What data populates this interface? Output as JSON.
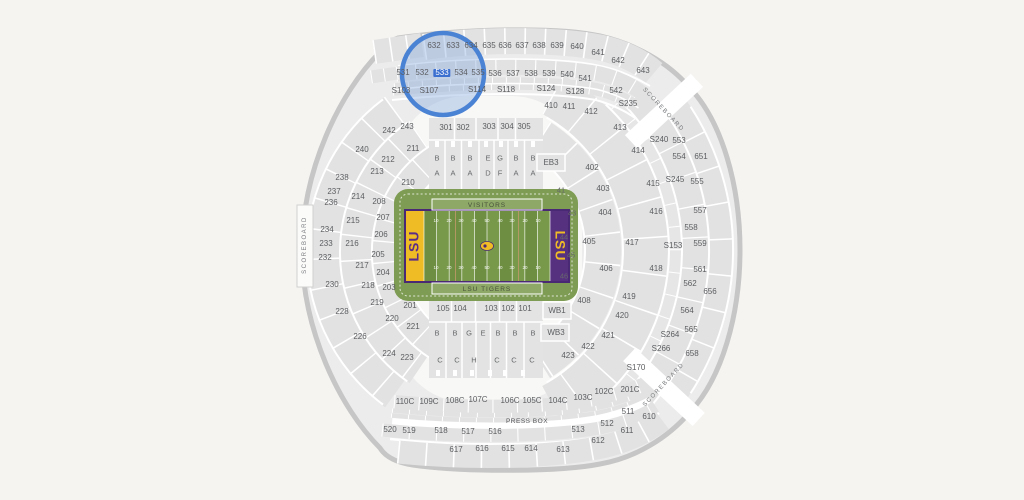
{
  "map": {
    "title": "stadium-seating-map",
    "background": "#f5f4f1",
    "highlight": {
      "section": "533",
      "circle_color": "#4a82d4",
      "circle_fill": "rgba(128,166,224,0.38)",
      "x": 443,
      "y": 74,
      "r": 41
    },
    "field": {
      "home_label": "LSU",
      "visitors_label": "VISITORS",
      "home_team_label": "LSU TIGERS",
      "colors": {
        "turf": "#6e8f41",
        "turf_stripe": "#78984a",
        "surround": "#7e9c53",
        "end_zone_left": "#efbc25",
        "end_zone_right": "#563180",
        "border": "#4a2974",
        "lsu_gold": "#f0bc26",
        "lsu_purple": "#5b2d87"
      }
    },
    "labels": [
      {
        "t": "632",
        "x": 434,
        "y": 46
      },
      {
        "t": "633",
        "x": 453,
        "y": 46
      },
      {
        "t": "634",
        "x": 471,
        "y": 46
      },
      {
        "t": "635",
        "x": 489,
        "y": 46
      },
      {
        "t": "636",
        "x": 505,
        "y": 46
      },
      {
        "t": "637",
        "x": 522,
        "y": 46
      },
      {
        "t": "638",
        "x": 539,
        "y": 46
      },
      {
        "t": "639",
        "x": 557,
        "y": 46
      },
      {
        "t": "640",
        "x": 577,
        "y": 47
      },
      {
        "t": "641",
        "x": 598,
        "y": 53
      },
      {
        "t": "642",
        "x": 618,
        "y": 61
      },
      {
        "t": "643",
        "x": 643,
        "y": 71
      },
      {
        "t": "531",
        "x": 403,
        "y": 73
      },
      {
        "t": "532",
        "x": 422,
        "y": 73
      },
      {
        "t": "533",
        "x": 442,
        "y": 73
      },
      {
        "t": "534",
        "x": 461,
        "y": 73
      },
      {
        "t": "535",
        "x": 478,
        "y": 73
      },
      {
        "t": "536",
        "x": 495,
        "y": 74
      },
      {
        "t": "537",
        "x": 513,
        "y": 74
      },
      {
        "t": "538",
        "x": 531,
        "y": 74
      },
      {
        "t": "539",
        "x": 549,
        "y": 74
      },
      {
        "t": "540",
        "x": 567,
        "y": 75
      },
      {
        "t": "541",
        "x": 585,
        "y": 79
      },
      {
        "t": "542",
        "x": 616,
        "y": 91
      },
      {
        "t": "S103",
        "x": 401,
        "y": 91
      },
      {
        "t": "S107",
        "x": 429,
        "y": 91
      },
      {
        "t": "S114",
        "x": 477,
        "y": 90
      },
      {
        "t": "S118",
        "x": 506,
        "y": 90
      },
      {
        "t": "S124",
        "x": 546,
        "y": 89
      },
      {
        "t": "S128",
        "x": 575,
        "y": 92
      },
      {
        "t": "S235",
        "x": 628,
        "y": 104
      },
      {
        "t": "410",
        "x": 551,
        "y": 106
      },
      {
        "t": "411",
        "x": 569,
        "y": 107
      },
      {
        "t": "412",
        "x": 591,
        "y": 112
      },
      {
        "t": "413",
        "x": 620,
        "y": 128
      },
      {
        "t": "414",
        "x": 638,
        "y": 151
      },
      {
        "t": "415",
        "x": 653,
        "y": 184
      },
      {
        "t": "416",
        "x": 656,
        "y": 212
      },
      {
        "t": "417",
        "x": 632,
        "y": 243
      },
      {
        "t": "418",
        "x": 656,
        "y": 269
      },
      {
        "t": "419",
        "x": 629,
        "y": 297
      },
      {
        "t": "420",
        "x": 622,
        "y": 316
      },
      {
        "t": "421",
        "x": 608,
        "y": 336
      },
      {
        "t": "422",
        "x": 588,
        "y": 347
      },
      {
        "t": "423",
        "x": 568,
        "y": 356
      },
      {
        "t": "402",
        "x": 592,
        "y": 168
      },
      {
        "t": "403",
        "x": 603,
        "y": 189
      },
      {
        "t": "404",
        "x": 605,
        "y": 213
      },
      {
        "t": "405",
        "x": 589,
        "y": 242
      },
      {
        "t": "406",
        "x": 606,
        "y": 269
      },
      {
        "t": "408",
        "x": 584,
        "y": 301
      },
      {
        "t": "S240",
        "x": 659,
        "y": 140
      },
      {
        "t": "553",
        "x": 679,
        "y": 141
      },
      {
        "t": "554",
        "x": 679,
        "y": 157
      },
      {
        "t": "651",
        "x": 701,
        "y": 157
      },
      {
        "t": "S245",
        "x": 675,
        "y": 180
      },
      {
        "t": "555",
        "x": 697,
        "y": 182
      },
      {
        "t": "557",
        "x": 700,
        "y": 211
      },
      {
        "t": "558",
        "x": 691,
        "y": 228
      },
      {
        "t": "559",
        "x": 700,
        "y": 244
      },
      {
        "t": "S153",
        "x": 673,
        "y": 246
      },
      {
        "t": "561",
        "x": 700,
        "y": 270
      },
      {
        "t": "562",
        "x": 690,
        "y": 284
      },
      {
        "t": "656",
        "x": 710,
        "y": 292
      },
      {
        "t": "564",
        "x": 687,
        "y": 311
      },
      {
        "t": "565",
        "x": 691,
        "y": 330
      },
      {
        "t": "S264",
        "x": 670,
        "y": 335
      },
      {
        "t": "S266",
        "x": 661,
        "y": 349
      },
      {
        "t": "658",
        "x": 692,
        "y": 354
      },
      {
        "t": "S170",
        "x": 636,
        "y": 368
      },
      {
        "t": "240",
        "x": 362,
        "y": 150
      },
      {
        "t": "238",
        "x": 342,
        "y": 178
      },
      {
        "t": "237",
        "x": 334,
        "y": 192
      },
      {
        "t": "236",
        "x": 331,
        "y": 203
      },
      {
        "t": "234",
        "x": 327,
        "y": 230
      },
      {
        "t": "233",
        "x": 326,
        "y": 244
      },
      {
        "t": "232",
        "x": 325,
        "y": 258
      },
      {
        "t": "230",
        "x": 332,
        "y": 285
      },
      {
        "t": "228",
        "x": 342,
        "y": 312
      },
      {
        "t": "226",
        "x": 360,
        "y": 337
      },
      {
        "t": "224",
        "x": 389,
        "y": 354
      },
      {
        "t": "242",
        "x": 389,
        "y": 131
      },
      {
        "t": "243",
        "x": 407,
        "y": 127
      },
      {
        "t": "211",
        "x": 413,
        "y": 149
      },
      {
        "t": "212",
        "x": 388,
        "y": 160
      },
      {
        "t": "213",
        "x": 377,
        "y": 172
      },
      {
        "t": "214",
        "x": 358,
        "y": 197
      },
      {
        "t": "215",
        "x": 353,
        "y": 221
      },
      {
        "t": "216",
        "x": 352,
        "y": 244
      },
      {
        "t": "217",
        "x": 362,
        "y": 266
      },
      {
        "t": "218",
        "x": 368,
        "y": 286
      },
      {
        "t": "219",
        "x": 377,
        "y": 303
      },
      {
        "t": "220",
        "x": 392,
        "y": 319
      },
      {
        "t": "221",
        "x": 413,
        "y": 327
      },
      {
        "t": "223",
        "x": 407,
        "y": 358
      },
      {
        "t": "210",
        "x": 408,
        "y": 183
      },
      {
        "t": "208",
        "x": 379,
        "y": 202
      },
      {
        "t": "207",
        "x": 383,
        "y": 218
      },
      {
        "t": "206",
        "x": 381,
        "y": 235
      },
      {
        "t": "205",
        "x": 378,
        "y": 255
      },
      {
        "t": "204",
        "x": 383,
        "y": 273
      },
      {
        "t": "203",
        "x": 389,
        "y": 288
      },
      {
        "t": "201",
        "x": 410,
        "y": 306
      },
      {
        "t": "301",
        "x": 446,
        "y": 128
      },
      {
        "t": "302",
        "x": 463,
        "y": 128
      },
      {
        "t": "303",
        "x": 489,
        "y": 127
      },
      {
        "t": "304",
        "x": 507,
        "y": 127
      },
      {
        "t": "305",
        "x": 524,
        "y": 127
      },
      {
        "t": "EB3",
        "x": 551,
        "y": 163
      },
      {
        "t": "WB1",
        "x": 557,
        "y": 311
      },
      {
        "t": "WB3",
        "x": 556,
        "y": 333
      },
      {
        "t": "105",
        "x": 443,
        "y": 309
      },
      {
        "t": "104",
        "x": 460,
        "y": 309
      },
      {
        "t": "103",
        "x": 491,
        "y": 309
      },
      {
        "t": "102",
        "x": 508,
        "y": 309
      },
      {
        "t": "101",
        "x": 525,
        "y": 309
      },
      {
        "t": "B",
        "x": 437,
        "y": 158,
        "c": "lt",
        "st": 1
      },
      {
        "t": "B",
        "x": 453,
        "y": 158,
        "c": "lt",
        "st": 1
      },
      {
        "t": "B",
        "x": 470,
        "y": 158,
        "c": "lt",
        "st": 1
      },
      {
        "t": "E",
        "x": 488,
        "y": 158,
        "c": "lt",
        "st": 1
      },
      {
        "t": "G",
        "x": 500,
        "y": 158,
        "c": "lt",
        "st": 1
      },
      {
        "t": "B",
        "x": 516,
        "y": 158,
        "c": "lt",
        "st": 1
      },
      {
        "t": "B",
        "x": 533,
        "y": 158,
        "c": "lt",
        "st": 1
      },
      {
        "t": "A",
        "x": 437,
        "y": 173,
        "c": "lt",
        "st": 1
      },
      {
        "t": "A",
        "x": 453,
        "y": 173,
        "c": "lt",
        "st": 1
      },
      {
        "t": "A",
        "x": 470,
        "y": 173,
        "c": "lt",
        "st": 1
      },
      {
        "t": "D",
        "x": 488,
        "y": 173,
        "c": "lt",
        "st": 1
      },
      {
        "t": "F",
        "x": 500,
        "y": 173,
        "c": "lt",
        "st": 1
      },
      {
        "t": "A",
        "x": 516,
        "y": 173,
        "c": "lt",
        "st": 1
      },
      {
        "t": "A",
        "x": 533,
        "y": 173,
        "c": "lt",
        "st": 1
      },
      {
        "t": "B",
        "x": 437,
        "y": 333,
        "c": "lt",
        "st": 1
      },
      {
        "t": "B",
        "x": 455,
        "y": 333,
        "c": "lt",
        "st": 1
      },
      {
        "t": "G",
        "x": 469,
        "y": 333,
        "c": "lt",
        "st": 1
      },
      {
        "t": "E",
        "x": 483,
        "y": 333,
        "c": "lt",
        "st": 1
      },
      {
        "t": "B",
        "x": 498,
        "y": 333,
        "c": "lt",
        "st": 1
      },
      {
        "t": "B",
        "x": 515,
        "y": 333,
        "c": "lt",
        "st": 1
      },
      {
        "t": "B",
        "x": 533,
        "y": 333,
        "c": "lt",
        "st": 1
      },
      {
        "t": "C",
        "x": 440,
        "y": 360,
        "c": "lt",
        "st": 1
      },
      {
        "t": "C",
        "x": 457,
        "y": 360,
        "c": "lt",
        "st": 1
      },
      {
        "t": "H",
        "x": 474,
        "y": 360,
        "c": "lt",
        "st": 1
      },
      {
        "t": "C",
        "x": 497,
        "y": 360,
        "c": "lt",
        "st": 1
      },
      {
        "t": "C",
        "x": 514,
        "y": 360,
        "c": "lt",
        "st": 1
      },
      {
        "t": "C",
        "x": 532,
        "y": 360,
        "c": "lt",
        "st": 1
      },
      {
        "t": "41",
        "x": 561,
        "y": 190,
        "c": "lt",
        "st": 1
      },
      {
        "t": "43",
        "x": 572,
        "y": 213,
        "c": "lt",
        "st": 1
      },
      {
        "t": "44",
        "x": 564,
        "y": 237,
        "c": "lt",
        "st": 1
      },
      {
        "t": "45",
        "x": 571,
        "y": 255,
        "c": "lt",
        "st": 1
      },
      {
        "t": "46",
        "x": 564,
        "y": 276,
        "c": "lt",
        "st": 1
      },
      {
        "t": "110C",
        "x": 405,
        "y": 402
      },
      {
        "t": "109C",
        "x": 429,
        "y": 402
      },
      {
        "t": "108C",
        "x": 455,
        "y": 401
      },
      {
        "t": "107C",
        "x": 478,
        "y": 400
      },
      {
        "t": "106C",
        "x": 510,
        "y": 401
      },
      {
        "t": "105C",
        "x": 532,
        "y": 401
      },
      {
        "t": "104C",
        "x": 558,
        "y": 401
      },
      {
        "t": "103C",
        "x": 583,
        "y": 398
      },
      {
        "t": "102C",
        "x": 604,
        "y": 392
      },
      {
        "t": "201C",
        "x": 630,
        "y": 390
      },
      {
        "t": "520",
        "x": 390,
        "y": 430
      },
      {
        "t": "519",
        "x": 409,
        "y": 431
      },
      {
        "t": "518",
        "x": 441,
        "y": 431
      },
      {
        "t": "517",
        "x": 468,
        "y": 432
      },
      {
        "t": "516",
        "x": 495,
        "y": 432
      },
      {
        "t": "513",
        "x": 578,
        "y": 430
      },
      {
        "t": "512",
        "x": 607,
        "y": 424
      },
      {
        "t": "511",
        "x": 628,
        "y": 412
      },
      {
        "t": "617",
        "x": 456,
        "y": 450
      },
      {
        "t": "616",
        "x": 482,
        "y": 449
      },
      {
        "t": "615",
        "x": 508,
        "y": 449
      },
      {
        "t": "614",
        "x": 531,
        "y": 449
      },
      {
        "t": "613",
        "x": 563,
        "y": 450
      },
      {
        "t": "612",
        "x": 598,
        "y": 441
      },
      {
        "t": "611",
        "x": 627,
        "y": 431
      },
      {
        "t": "610",
        "x": 649,
        "y": 417
      },
      {
        "t": "PRESS BOX",
        "x": 527,
        "y": 422,
        "c": "pb",
        "st": 1
      },
      {
        "t": "SCOREBOARD",
        "x": 305,
        "y": 245,
        "r": -90,
        "c": "sb",
        "st": 1
      },
      {
        "t": "SCOREBOARD",
        "x": 663,
        "y": 110,
        "r": 47,
        "c": "sb",
        "st": 1
      },
      {
        "t": "SCOREBOARD",
        "x": 664,
        "y": 385,
        "r": -47,
        "c": "sb",
        "st": 1
      },
      {
        "t": "10",
        "x": 436,
        "y": 221,
        "c": "yard",
        "st": 1
      },
      {
        "t": "20",
        "x": 449,
        "y": 221,
        "c": "yard",
        "st": 1
      },
      {
        "t": "30",
        "x": 461,
        "y": 221,
        "c": "yard",
        "st": 1
      },
      {
        "t": "40",
        "x": 474,
        "y": 221,
        "c": "yard",
        "st": 1
      },
      {
        "t": "50",
        "x": 487,
        "y": 221,
        "c": "yard",
        "st": 1
      },
      {
        "t": "40",
        "x": 500,
        "y": 221,
        "c": "yard",
        "st": 1
      },
      {
        "t": "30",
        "x": 512,
        "y": 221,
        "c": "yard",
        "st": 1
      },
      {
        "t": "20",
        "x": 525,
        "y": 221,
        "c": "yard",
        "st": 1
      },
      {
        "t": "10",
        "x": 538,
        "y": 221,
        "c": "yard",
        "st": 1
      },
      {
        "t": "10",
        "x": 436,
        "y": 268,
        "c": "yard",
        "st": 1
      },
      {
        "t": "20",
        "x": 449,
        "y": 268,
        "c": "yard",
        "st": 1
      },
      {
        "t": "30",
        "x": 461,
        "y": 268,
        "c": "yard",
        "st": 1
      },
      {
        "t": "40",
        "x": 474,
        "y": 268,
        "c": "yard",
        "st": 1
      },
      {
        "t": "50",
        "x": 487,
        "y": 268,
        "c": "yard",
        "st": 1
      },
      {
        "t": "40",
        "x": 500,
        "y": 268,
        "c": "yard",
        "st": 1
      },
      {
        "t": "30",
        "x": 512,
        "y": 268,
        "c": "yard",
        "st": 1
      },
      {
        "t": "20",
        "x": 525,
        "y": 268,
        "c": "yard",
        "st": 1
      },
      {
        "t": "10",
        "x": 538,
        "y": 268,
        "c": "yard",
        "st": 1
      }
    ]
  }
}
